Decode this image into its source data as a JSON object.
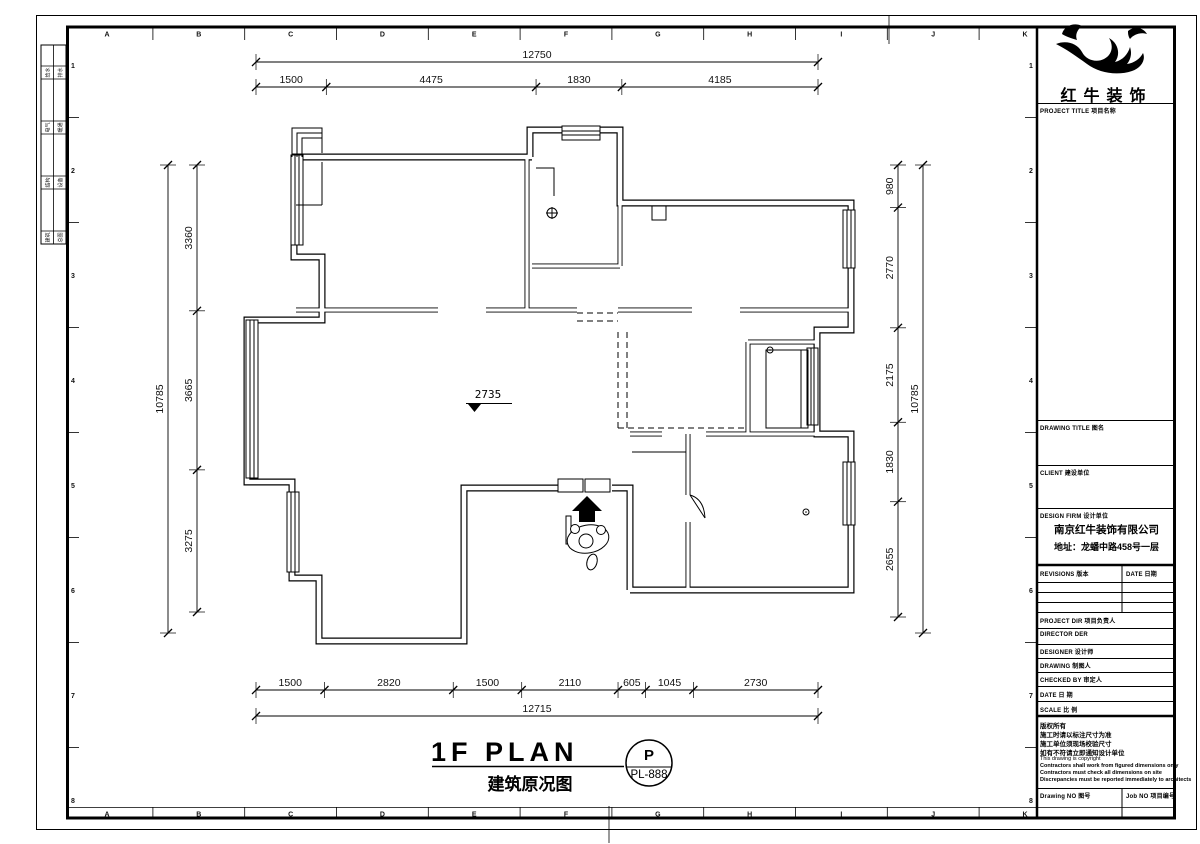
{
  "sheet": {
    "grid_letters": [
      "A",
      "B",
      "C",
      "D",
      "E",
      "F",
      "G",
      "H",
      "I",
      "J",
      "K"
    ],
    "grid_numbers": [
      "1",
      "2",
      "3",
      "4",
      "5",
      "6",
      "7",
      "8"
    ],
    "signoff_rows": [
      [
        "给水",
        "排水"
      ],
      [
        "电气",
        "暖通"
      ],
      [
        "结构",
        "设备"
      ],
      [
        "建筑",
        "总图"
      ]
    ]
  },
  "plan": {
    "level_marker": "2735",
    "title": "1F PLAN",
    "subtitle": "建筑原况图",
    "stamp_letter": "P",
    "stamp_number": "PL-888",
    "dims": {
      "top_overall": [
        "12750"
      ],
      "top_segments": [
        "1500",
        "4475",
        "1830",
        "4185"
      ],
      "bottom_segments": [
        "1500",
        "2820",
        "1500",
        "2110",
        "605",
        "1045",
        "2730"
      ],
      "bottom_overall": [
        "12715"
      ],
      "left_overall": [
        "10785"
      ],
      "left_segments": [
        "3360",
        "3665",
        "3275"
      ],
      "right_segments": [
        "980",
        "2770",
        "2175",
        "1830",
        "2655"
      ],
      "right_overall": [
        "10785"
      ]
    }
  },
  "title_block": {
    "logo_text": "红牛装饰",
    "project_title_label": "PROJECT TITLE  项目名称",
    "drawing_title_label": "DRAWING TITLE  图名",
    "client_label": "CLIENT  建设单位",
    "design_firm_label": "DESIGN FIRM  设计单位",
    "company_name": "南京红牛装饰有限公司",
    "company_address": "地址：龙蟠中路458号一层",
    "revisions_label": "REVISIONS  版本",
    "date_col_label": "DATE  日期",
    "project_dir_label": "PROJECT DIR  项目负责人",
    "director_label": "DIRECTOR DER",
    "designer_label": "DESIGNER  设计师",
    "drawing_label": "DRAWING  制图人",
    "checked_label": "CHECKED BY  审定人",
    "date_label": "DATE  日 期",
    "scale_label": "SCALE  比 例",
    "copyright_lines": [
      "版权所有",
      "施工时请以标注尺寸为准",
      "施工单位须现场校验尺寸",
      "如有不符请立即通知设计单位",
      "This drawing is copyright",
      "Contractors shall work from figured dimensions only",
      "Contractors must check all dimensions on site",
      "Discrepancies must be reported immediately to architects"
    ],
    "drawing_no_label": "Drawing NO  图号",
    "job_no_label": "Job NO  项目编号"
  }
}
